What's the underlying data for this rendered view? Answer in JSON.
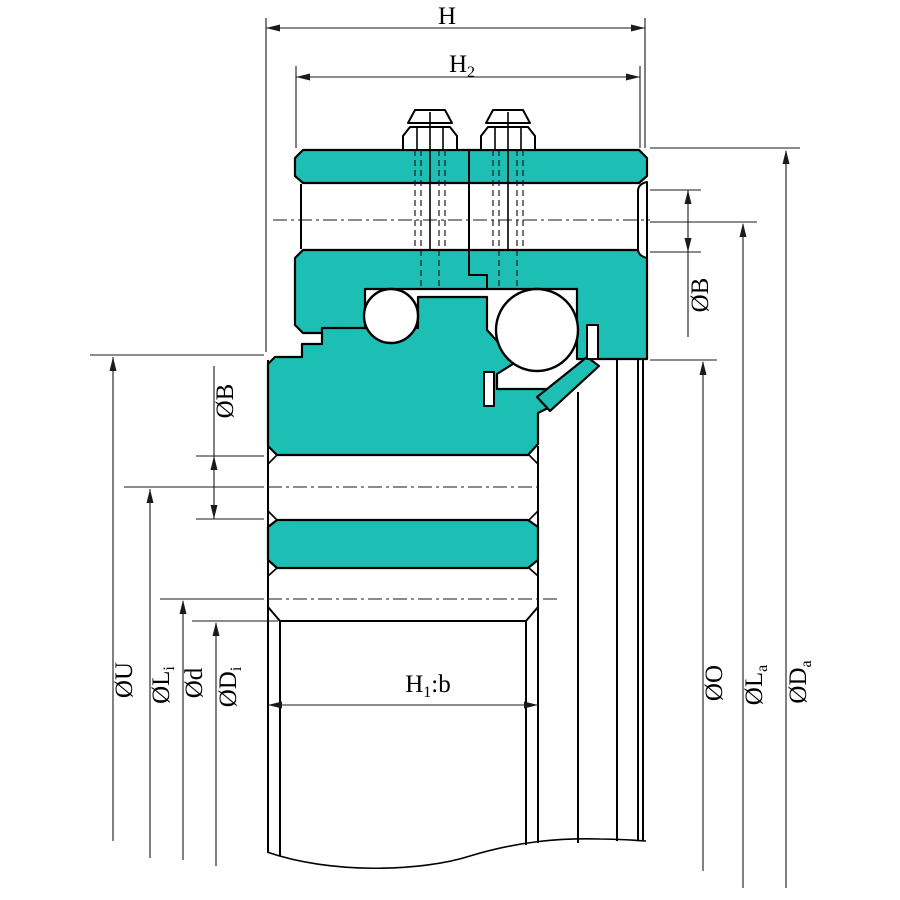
{
  "drawing": {
    "type": "bearing-unit-cross-section",
    "background": "#ffffff",
    "colors": {
      "part_fill": "#1dbfb5",
      "outline": "#000000",
      "dimension_lines": "#1a1a1a"
    },
    "labels": {
      "h": {
        "pre": "H",
        "sub": "",
        "post": ""
      },
      "h2": {
        "pre": "H",
        "sub": "2",
        "post": ""
      },
      "h1b": {
        "pre": "H",
        "sub": "1",
        "post": ":b"
      },
      "b_right": {
        "pre": "ØB",
        "sub": "",
        "post": ""
      },
      "b_left": {
        "pre": "ØB",
        "sub": "",
        "post": ""
      },
      "u": {
        "pre": "ØU",
        "sub": "",
        "post": ""
      },
      "li": {
        "pre": "ØL",
        "sub": "i",
        "post": ""
      },
      "d": {
        "pre": "Ød",
        "sub": "",
        "post": ""
      },
      "di": {
        "pre": "ØD",
        "sub": "i",
        "post": ""
      },
      "o": {
        "pre": "ØO",
        "sub": "",
        "post": ""
      },
      "la": {
        "pre": "ØL",
        "sub": "a",
        "post": ""
      },
      "da": {
        "pre": "ØD",
        "sub": "a",
        "post": ""
      }
    }
  }
}
